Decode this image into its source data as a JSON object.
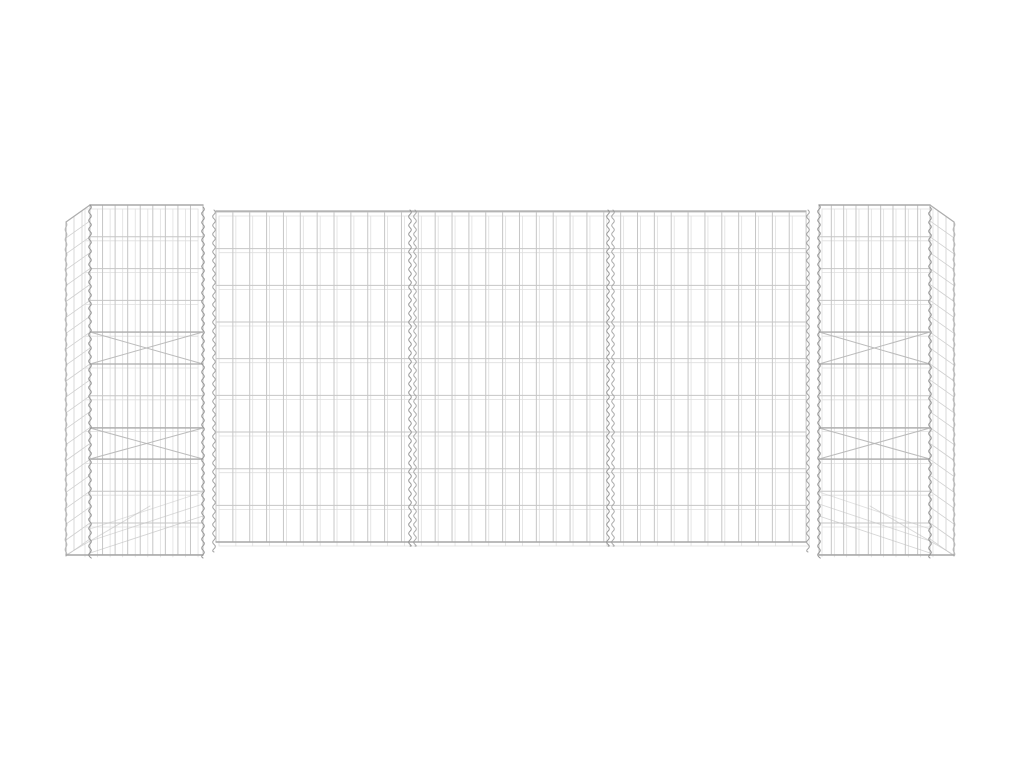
{
  "image": {
    "alt": "H-shaped gabion wire mesh planter basket made of silver galvanized steel, two square mesh towers connected by a long three-panel mesh wall, on a plain white background",
    "background": "#ffffff"
  },
  "colors": {
    "background": "#ffffff",
    "wire": "#c6c6c6",
    "wire_ghost": "#dcdcdc",
    "rim": "#a8a8a8",
    "spiral": "#8f8f8f",
    "brace": "#a9a9a9"
  },
  "scene": {
    "w": 1024,
    "h": 768,
    "elements": [
      {
        "t": "grid",
        "n": "left-tower-side-mesh",
        "x": 66,
        "y": 222,
        "w": 24,
        "h": 334,
        "vs": 8,
        "hs": 15.9,
        "shear": -17,
        "c": "#c4c4c4",
        "sw": 0.8,
        "o": 0.8
      },
      {
        "t": "grid",
        "n": "left-tower-back-mesh",
        "x": 85,
        "y": 209,
        "w": 113,
        "h": 348,
        "vs": 12.56,
        "hs": 31.8,
        "shear": 0,
        "c": "#dcdcdc",
        "sw": 0.8,
        "o": 0.9
      },
      {
        "t": "grid",
        "n": "left-tower-front-mesh",
        "x": 90,
        "y": 205,
        "w": 113,
        "h": 350,
        "vs": 12.56,
        "hs": 31.8,
        "shear": 0,
        "c": "#c6c6c6",
        "sw": 1,
        "o": 1
      },
      {
        "t": "line",
        "n": "left-tower-top-rim",
        "x1": 90,
        "y1": 205,
        "x2": 203,
        "y2": 205,
        "c": "#a9a9a9",
        "sw": 1.4,
        "o": 1
      },
      {
        "t": "line",
        "n": "left-tower-side-top-rim",
        "x1": 66,
        "y1": 222,
        "x2": 90,
        "y2": 205,
        "c": "#adadad",
        "sw": 1.2,
        "o": 1
      },
      {
        "t": "line",
        "n": "left-tower-outer-corner-wire",
        "x1": 66,
        "y1": 222,
        "x2": 66,
        "y2": 556,
        "c": "#b2b2b2",
        "sw": 1,
        "o": 1
      },
      {
        "t": "spiral",
        "n": "left-tower-outer-spiral",
        "x": 66,
        "y1": 222,
        "y2": 556,
        "amp": 2,
        "step": 5,
        "c": "#a8a8a8",
        "sw": 0.9,
        "o": 0.7
      },
      {
        "t": "line",
        "n": "left-tower-brace-wire",
        "x1": 90,
        "y1": 332,
        "x2": 203,
        "y2": 332,
        "c": "#a9a9a9",
        "sw": 1.2,
        "o": 0.95
      },
      {
        "t": "line",
        "n": "left-tower-brace-wire",
        "x1": 90,
        "y1": 364,
        "x2": 203,
        "y2": 364,
        "c": "#a9a9a9",
        "sw": 1.2,
        "o": 0.95
      },
      {
        "t": "line",
        "n": "left-tower-brace-wire",
        "x1": 90,
        "y1": 428,
        "x2": 203,
        "y2": 428,
        "c": "#a9a9a9",
        "sw": 1.2,
        "o": 0.95
      },
      {
        "t": "line",
        "n": "left-tower-brace-wire",
        "x1": 90,
        "y1": 459,
        "x2": 203,
        "y2": 459,
        "c": "#a9a9a9",
        "sw": 1.2,
        "o": 0.95
      },
      {
        "t": "line",
        "n": "left-tower-cross-brace",
        "x1": 90,
        "y1": 332,
        "x2": 203,
        "y2": 364,
        "c": "#b5b5b5",
        "sw": 1,
        "o": 0.9
      },
      {
        "t": "line",
        "n": "left-tower-cross-brace",
        "x1": 90,
        "y1": 364,
        "x2": 203,
        "y2": 332,
        "c": "#b5b5b5",
        "sw": 1,
        "o": 0.9
      },
      {
        "t": "line",
        "n": "left-tower-cross-brace",
        "x1": 90,
        "y1": 428,
        "x2": 203,
        "y2": 459,
        "c": "#b5b5b5",
        "sw": 1,
        "o": 0.9
      },
      {
        "t": "line",
        "n": "left-tower-cross-brace",
        "x1": 90,
        "y1": 459,
        "x2": 203,
        "y2": 428,
        "c": "#b5b5b5",
        "sw": 1,
        "o": 0.9
      },
      {
        "t": "line",
        "n": "left-tower-floor-wire",
        "x1": 90,
        "y1": 553,
        "x2": 203,
        "y2": 516,
        "c": "#c2c2c2",
        "sw": 0.9,
        "o": 0.7
      },
      {
        "t": "line",
        "n": "left-tower-floor-wire",
        "x1": 90,
        "y1": 541,
        "x2": 203,
        "y2": 504,
        "c": "#c2c2c2",
        "sw": 0.9,
        "o": 0.6
      },
      {
        "t": "line",
        "n": "left-tower-floor-wire",
        "x1": 90,
        "y1": 529,
        "x2": 203,
        "y2": 492,
        "c": "#c2c2c2",
        "sw": 0.9,
        "o": 0.5
      },
      {
        "t": "line",
        "n": "left-tower-floor-edge",
        "x1": 66,
        "y1": 555,
        "x2": 150,
        "y2": 506,
        "c": "#c0c0c0",
        "sw": 0.9,
        "o": 0.6
      },
      {
        "t": "line",
        "n": "left-tower-bottom-rim",
        "x1": 66,
        "y1": 555,
        "x2": 203,
        "y2": 555,
        "c": "#a6a6a6",
        "sw": 1.4,
        "o": 1
      },
      {
        "t": "spiral",
        "n": "left-tower-front-left-spiral",
        "x": 90,
        "y1": 205,
        "y2": 557,
        "amp": 2.6,
        "step": 4.4,
        "c": "#8f8f8f",
        "sw": 1,
        "o": 0.95
      },
      {
        "t": "spiral",
        "n": "left-tower-front-right-spiral",
        "x": 203,
        "y1": 207,
        "y2": 558,
        "amp": 2.6,
        "step": 4.4,
        "c": "#8f8f8f",
        "sw": 1,
        "o": 0.95
      },
      {
        "t": "spiral",
        "n": "left-junction-spiral",
        "x": 214,
        "y1": 210,
        "y2": 552,
        "amp": 2.6,
        "step": 4.4,
        "c": "#979797",
        "sw": 1,
        "o": 0.9
      },
      {
        "t": "grid",
        "n": "wall-back-mesh",
        "x": 219,
        "y": 216,
        "w": 590,
        "h": 330,
        "vs": 16.86,
        "hs": 36.67,
        "shear": 0,
        "c": "#dcdcdc",
        "sw": 0.8,
        "o": 0.9
      },
      {
        "t": "grid",
        "n": "wall-front-mesh",
        "x": 216,
        "y": 212,
        "w": 590,
        "h": 330,
        "vs": 16.86,
        "hs": 36.67,
        "shear": 0,
        "c": "#c6c6c6",
        "sw": 1,
        "o": 1
      },
      {
        "t": "line",
        "n": "wall-top-rim",
        "x1": 216,
        "y1": 211,
        "x2": 806,
        "y2": 211,
        "c": "#aaaaaa",
        "sw": 1.3,
        "o": 1
      },
      {
        "t": "line",
        "n": "wall-bottom-rim",
        "x1": 216,
        "y1": 542,
        "x2": 806,
        "y2": 542,
        "c": "#a6a6a6",
        "sw": 1.4,
        "o": 1
      },
      {
        "t": "spiral",
        "n": "wall-divider-spiral",
        "x": 410,
        "y1": 210,
        "y2": 546,
        "amp": 2.6,
        "step": 4.4,
        "c": "#8f8f8f",
        "sw": 1,
        "o": 0.95
      },
      {
        "t": "spiral",
        "n": "wall-divider-spiral",
        "x": 415,
        "y1": 210,
        "y2": 546,
        "amp": 2.6,
        "step": 4.4,
        "c": "#9a9a9a",
        "sw": 1,
        "o": 0.85
      },
      {
        "t": "spiral",
        "n": "wall-divider-spiral",
        "x": 608,
        "y1": 210,
        "y2": 546,
        "amp": 2.6,
        "step": 4.4,
        "c": "#8f8f8f",
        "sw": 1,
        "o": 0.95
      },
      {
        "t": "spiral",
        "n": "wall-divider-spiral",
        "x": 613,
        "y1": 210,
        "y2": 546,
        "amp": 2.6,
        "step": 4.4,
        "c": "#9a9a9a",
        "sw": 1,
        "o": 0.85
      },
      {
        "t": "grid",
        "n": "right-tower-side-mesh",
        "x": 930,
        "y": 205,
        "w": 24,
        "h": 334,
        "vs": 8,
        "hs": 15.9,
        "shear": 17,
        "c": "#c4c4c4",
        "sw": 0.8,
        "o": 0.8
      },
      {
        "t": "grid",
        "n": "right-tower-back-mesh",
        "x": 822,
        "y": 209,
        "w": 111,
        "h": 348,
        "vs": 12.33,
        "hs": 31.8,
        "shear": 0,
        "c": "#dcdcdc",
        "sw": 0.8,
        "o": 0.9
      },
      {
        "t": "grid",
        "n": "right-tower-front-mesh",
        "x": 819,
        "y": 205,
        "w": 111,
        "h": 350,
        "vs": 12.33,
        "hs": 31.8,
        "shear": 0,
        "c": "#c6c6c6",
        "sw": 1,
        "o": 1
      },
      {
        "t": "line",
        "n": "right-tower-top-rim",
        "x1": 819,
        "y1": 205,
        "x2": 930,
        "y2": 205,
        "c": "#a9a9a9",
        "sw": 1.4,
        "o": 1
      },
      {
        "t": "line",
        "n": "right-tower-side-top-rim",
        "x1": 930,
        "y1": 205,
        "x2": 954,
        "y2": 222,
        "c": "#adadad",
        "sw": 1.2,
        "o": 1
      },
      {
        "t": "line",
        "n": "right-tower-outer-corner-wire",
        "x1": 954,
        "y1": 222,
        "x2": 954,
        "y2": 556,
        "c": "#b2b2b2",
        "sw": 1,
        "o": 1
      },
      {
        "t": "spiral",
        "n": "right-tower-outer-spiral",
        "x": 954,
        "y1": 222,
        "y2": 556,
        "amp": 2,
        "step": 5,
        "c": "#a8a8a8",
        "sw": 0.9,
        "o": 0.7
      },
      {
        "t": "line",
        "n": "right-tower-brace-wire",
        "x1": 819,
        "y1": 332,
        "x2": 930,
        "y2": 332,
        "c": "#a9a9a9",
        "sw": 1.2,
        "o": 0.95
      },
      {
        "t": "line",
        "n": "right-tower-brace-wire",
        "x1": 819,
        "y1": 364,
        "x2": 930,
        "y2": 364,
        "c": "#a9a9a9",
        "sw": 1.2,
        "o": 0.95
      },
      {
        "t": "line",
        "n": "right-tower-brace-wire",
        "x1": 819,
        "y1": 428,
        "x2": 930,
        "y2": 428,
        "c": "#a9a9a9",
        "sw": 1.2,
        "o": 0.95
      },
      {
        "t": "line",
        "n": "right-tower-brace-wire",
        "x1": 819,
        "y1": 459,
        "x2": 930,
        "y2": 459,
        "c": "#a9a9a9",
        "sw": 1.2,
        "o": 0.95
      },
      {
        "t": "line",
        "n": "right-tower-cross-brace",
        "x1": 819,
        "y1": 332,
        "x2": 930,
        "y2": 364,
        "c": "#b5b5b5",
        "sw": 1,
        "o": 0.9
      },
      {
        "t": "line",
        "n": "right-tower-cross-brace",
        "x1": 819,
        "y1": 364,
        "x2": 930,
        "y2": 332,
        "c": "#b5b5b5",
        "sw": 1,
        "o": 0.9
      },
      {
        "t": "line",
        "n": "right-tower-cross-brace",
        "x1": 819,
        "y1": 428,
        "x2": 930,
        "y2": 459,
        "c": "#b5b5b5",
        "sw": 1,
        "o": 0.9
      },
      {
        "t": "line",
        "n": "right-tower-cross-brace",
        "x1": 819,
        "y1": 459,
        "x2": 930,
        "y2": 428,
        "c": "#b5b5b5",
        "sw": 1,
        "o": 0.9
      },
      {
        "t": "line",
        "n": "right-tower-floor-wire",
        "x1": 819,
        "y1": 516,
        "x2": 930,
        "y2": 553,
        "c": "#c2c2c2",
        "sw": 0.9,
        "o": 0.7
      },
      {
        "t": "line",
        "n": "right-tower-floor-wire",
        "x1": 819,
        "y1": 504,
        "x2": 930,
        "y2": 541,
        "c": "#c2c2c2",
        "sw": 0.9,
        "o": 0.6
      },
      {
        "t": "line",
        "n": "right-tower-floor-wire",
        "x1": 819,
        "y1": 492,
        "x2": 930,
        "y2": 529,
        "c": "#c2c2c2",
        "sw": 0.9,
        "o": 0.5
      },
      {
        "t": "line",
        "n": "right-tower-floor-edge",
        "x1": 954,
        "y1": 555,
        "x2": 870,
        "y2": 506,
        "c": "#c0c0c0",
        "sw": 0.9,
        "o": 0.6
      },
      {
        "t": "line",
        "n": "right-tower-bottom-rim",
        "x1": 819,
        "y1": 555,
        "x2": 954,
        "y2": 555,
        "c": "#a6a6a6",
        "sw": 1.4,
        "o": 1
      },
      {
        "t": "spiral",
        "n": "right-junction-spiral",
        "x": 808,
        "y1": 210,
        "y2": 552,
        "amp": 2.6,
        "step": 4.4,
        "c": "#979797",
        "sw": 1,
        "o": 0.9
      },
      {
        "t": "spiral",
        "n": "right-tower-front-left-spiral",
        "x": 819,
        "y1": 205,
        "y2": 557,
        "amp": 2.6,
        "step": 4.4,
        "c": "#8f8f8f",
        "sw": 1,
        "o": 0.95
      },
      {
        "t": "spiral",
        "n": "right-tower-front-right-spiral",
        "x": 930,
        "y1": 207,
        "y2": 558,
        "amp": 2.6,
        "step": 4.4,
        "c": "#8f8f8f",
        "sw": 1,
        "o": 0.95
      }
    ]
  }
}
